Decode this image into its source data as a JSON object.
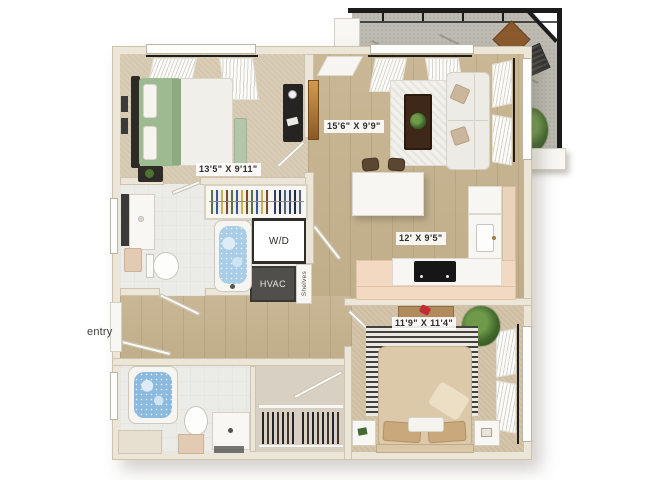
{
  "image_type": "3d-apartment-floor-plan",
  "labels": {
    "bedroom1_dims": "13'5\" X 9'11\"",
    "living_dims": "15'6\" X 9'9\"",
    "kitchen_dims": "12' X 9'5\"",
    "bedroom2_dims": "11'9\" X 11'4\"",
    "washer_dryer": "W/D",
    "hvac": "HVAC",
    "shelves": "Shelves",
    "entry": "entry"
  },
  "colors": {
    "background": "#ffffff",
    "wall": "#ece6d8",
    "wood_floor": "#c5b28e",
    "bedroom_carpet": "#dacdb6",
    "bathroom_floor": "#ebebe7",
    "bath_water": "#a9cde6",
    "kitchen_bar": "#f3d8c2",
    "hvac_box": "#514f4c",
    "balcony_frame": "#1c1c1c",
    "balcony_floor": "#bdbbb2",
    "bed1_bedding": "#9eba93",
    "bed2_bedding": "#dcc9a9"
  }
}
